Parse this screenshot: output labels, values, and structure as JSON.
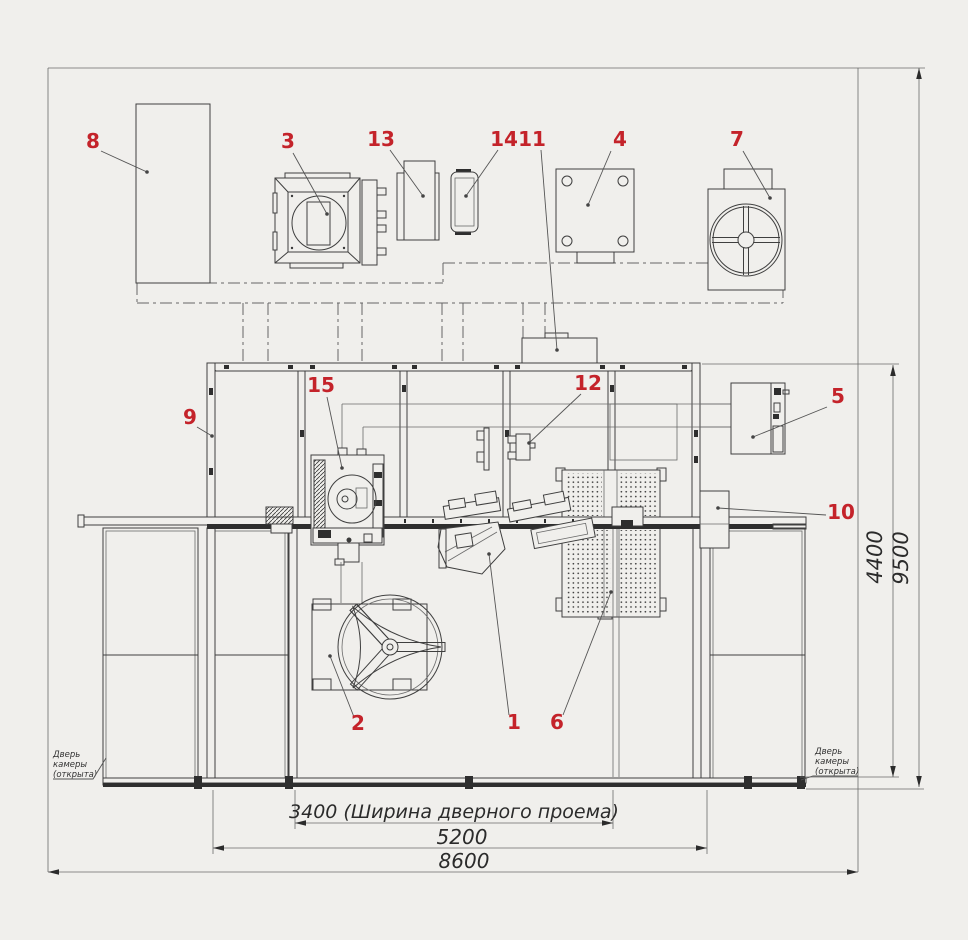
{
  "title": "Компоновка роботизированной сварочной камеры (план)",
  "colors": {
    "background": "#f0efec",
    "line": "#3f3f3f",
    "callout_red": "#c4232a",
    "rail_dark": "#2e2e2e"
  },
  "callouts": {
    "c1": "1",
    "c2": "2",
    "c3": "3",
    "c4": "4",
    "c5": "5",
    "c6": "6",
    "c7": "7",
    "c8": "8",
    "c9": "9",
    "c10": "10",
    "c11": "11",
    "c12": "12",
    "c13": "13",
    "c14": "14",
    "c15": "15"
  },
  "dimensions": {
    "door_width": "3400 (Ширина дверного проема)",
    "width_mid": "5200",
    "width_total": "8600",
    "depth_inner": "4400",
    "depth_total": "9500"
  },
  "notes": {
    "door_open": {
      "line1": "Дверь",
      "line2": "камеры",
      "line3": "(открыта)"
    }
  }
}
